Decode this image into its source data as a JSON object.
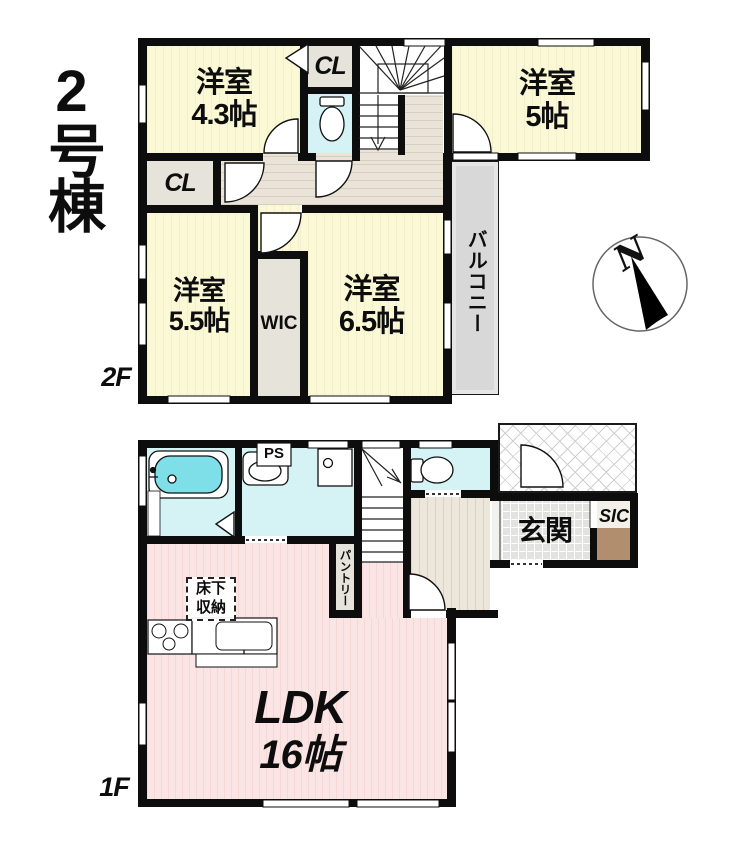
{
  "title": "2号棟",
  "compass": {
    "north": "N"
  },
  "floor2": {
    "label": "2F",
    "rooms": {
      "room43": {
        "name": "洋室",
        "size": "4.3帖"
      },
      "closet_top": {
        "name": "CL"
      },
      "room5": {
        "name": "洋室",
        "size": "5帖"
      },
      "closet_left": {
        "name": "CL"
      },
      "room55": {
        "name": "洋室",
        "size": "5.5帖"
      },
      "wic": {
        "name": "WIC"
      },
      "room65": {
        "name": "洋室",
        "size": "6.5帖"
      },
      "balcony": {
        "name": "バルコニー"
      }
    }
  },
  "floor1": {
    "label": "1F",
    "rooms": {
      "ldk": {
        "name": "LDK",
        "size": "16帖"
      },
      "genkan": {
        "name": "玄関"
      },
      "sic": {
        "name": "SIC"
      },
      "pantry": {
        "name": "パントリー"
      },
      "pipe_space": {
        "name": "PS"
      },
      "floor_storage": {
        "line1": "床下",
        "line2": "収納"
      }
    }
  },
  "colors": {
    "room_yellow": "#FBF8D6",
    "water_cyan": "#D5F2F4",
    "tub_cyan": "#7EDFE8",
    "ldk_pink": "#FBE5E4",
    "hall_beige": "#EAE4D8",
    "closet_gray": "#E6E3DA",
    "balcony_gray": "#D8D8D8",
    "entrance_tile": "#E2E2E0",
    "sic_brown": "#B18F6E",
    "wall_black": "#0D0D0D"
  }
}
